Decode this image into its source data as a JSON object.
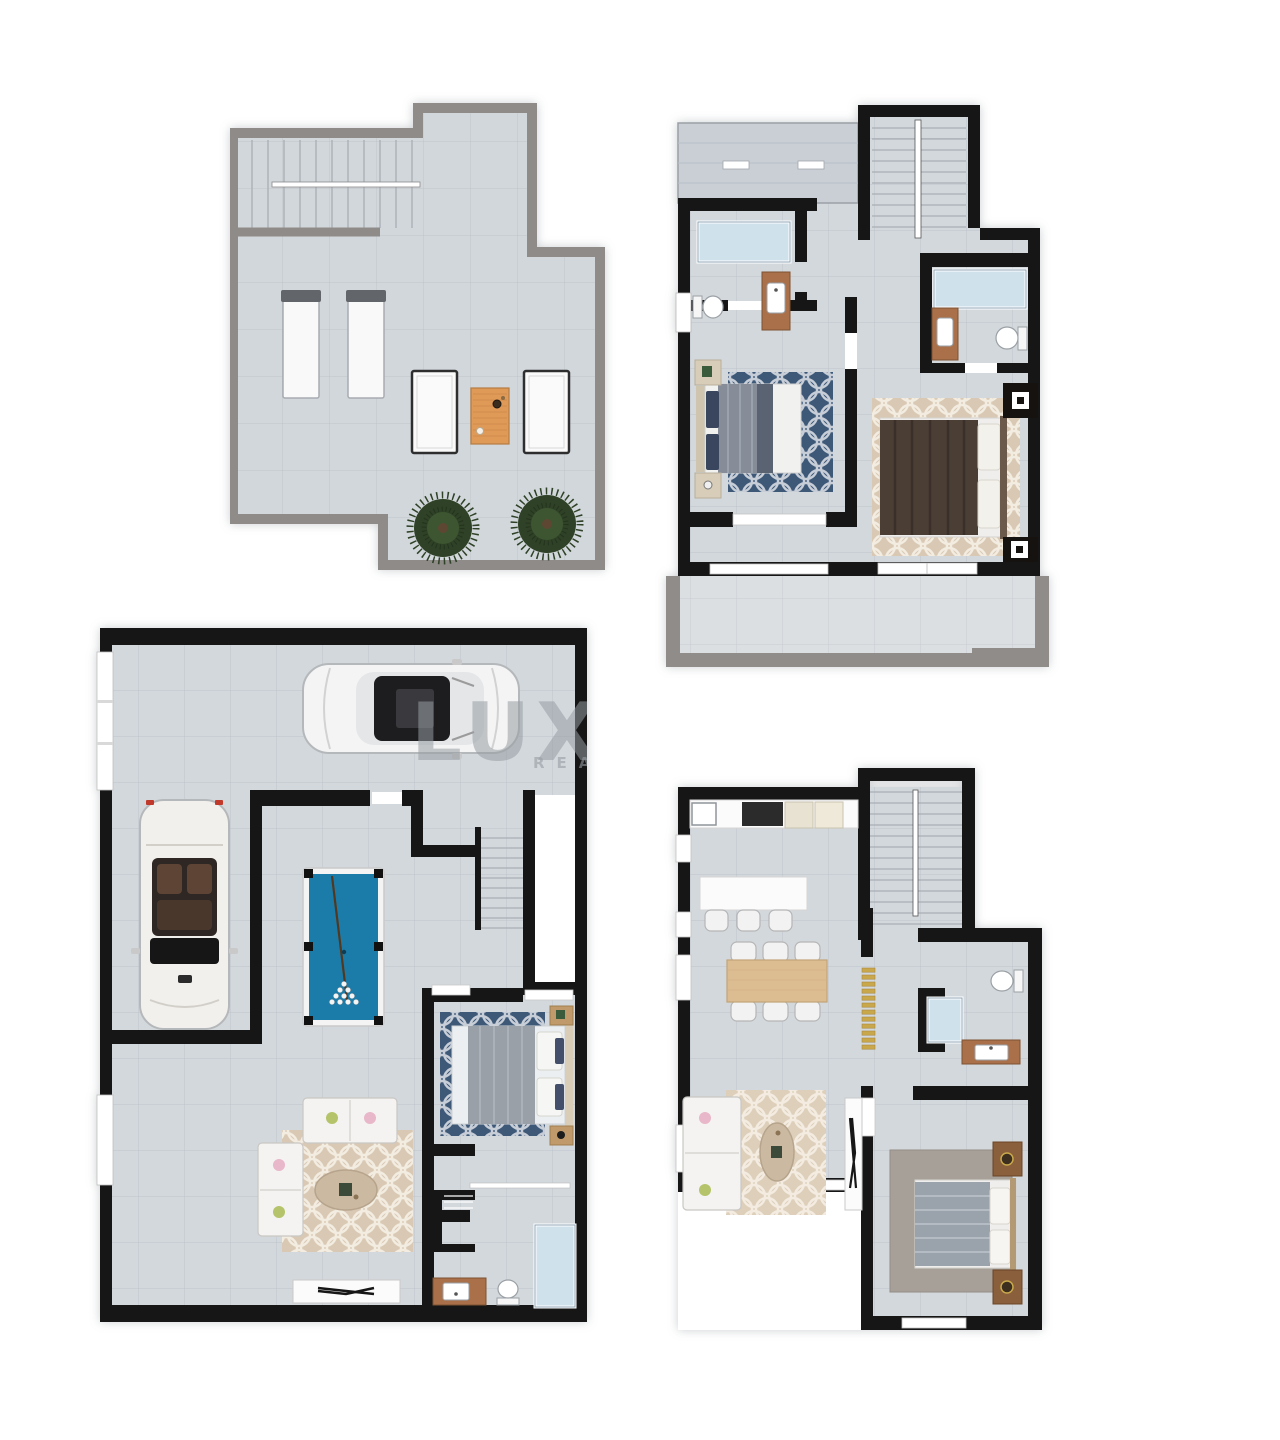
{
  "document": {
    "title": "Villa floor plans - four levels",
    "background": "#ffffff",
    "width": 1280,
    "height": 1440
  },
  "watermark": {
    "line1": "LUX",
    "line2": "REA"
  },
  "palette": {
    "floor_tile": "#d3d8dc",
    "tile_grout": "#bcc3ca",
    "wall_interior": "#161616",
    "wall_parapet": "#908c89",
    "shower_glass": "#cfe2ec",
    "rug_navy": "#3e5878",
    "rug_beige": "#d9c9b4",
    "rug_gray": "#a7a099",
    "billiard_felt": "#1b7ca9",
    "wood_vanity": "#a9704a",
    "wood_dining": "#dcbd92",
    "wood_deck": "#e09a58",
    "slat_gold": "#c9a84c",
    "plant_green": "#2f4227",
    "sofa_white": "#f4f3f1",
    "bed_dark_brown": "#4a3e35",
    "bed_gray": "#9aa0a8"
  },
  "plans": [
    {
      "id": "roof-terrace",
      "position": "top-left",
      "wall_style": "concrete-parapet",
      "rooms": [
        {
          "name": "stair-access",
          "items": [
            "staircase"
          ]
        },
        {
          "name": "terrace",
          "items": [
            "sun-lounger",
            "sun-lounger",
            "lounge-chair",
            "lounge-chair",
            "wood-coffee-table",
            "potted-plant",
            "potted-plant"
          ]
        }
      ]
    },
    {
      "id": "bedroom-floor",
      "position": "top-right",
      "wall_style": "solid-black",
      "rooms": [
        {
          "name": "stairwell",
          "items": [
            "staircase"
          ]
        },
        {
          "name": "bathroom-1",
          "items": [
            "shower",
            "toilet",
            "vanity-sink",
            "window"
          ]
        },
        {
          "name": "bedroom-1",
          "items": [
            "double-bed",
            "night-table",
            "night-table",
            "navy-patterned-rug",
            "window"
          ]
        },
        {
          "name": "bathroom-2",
          "items": [
            "shower",
            "vanity-sink",
            "toilet"
          ]
        },
        {
          "name": "bedroom-2",
          "items": [
            "double-bed",
            "night-table",
            "night-table",
            "beige-patterned-rug"
          ]
        },
        {
          "name": "terrace",
          "items": [
            "parapet",
            "sliding-door"
          ]
        }
      ]
    },
    {
      "id": "basement-garage",
      "position": "bottom-left",
      "wall_style": "solid-black",
      "rooms": [
        {
          "name": "garage",
          "items": [
            "sedan-car",
            "convertible-car",
            "garage-door"
          ]
        },
        {
          "name": "games-area",
          "items": [
            "billiard-table"
          ]
        },
        {
          "name": "stairwell",
          "items": [
            "staircase",
            "lightwell"
          ]
        },
        {
          "name": "lounge",
          "items": [
            "sofa",
            "sofa",
            "beige-patterned-rug",
            "oval-coffee-table",
            "tv-console"
          ]
        },
        {
          "name": "bedroom",
          "items": [
            "double-bed",
            "night-table",
            "night-table",
            "navy-patterned-rug"
          ]
        },
        {
          "name": "bathroom",
          "items": [
            "shower",
            "toilet",
            "vanity-sink",
            "closet"
          ]
        }
      ]
    },
    {
      "id": "ground-floor",
      "position": "bottom-right",
      "wall_style": "solid-black",
      "rooms": [
        {
          "name": "kitchen",
          "items": [
            "sink",
            "cooktop",
            "appliance",
            "appliance",
            "island-counter",
            "bar-stool",
            "bar-stool",
            "bar-stool"
          ]
        },
        {
          "name": "dining",
          "items": [
            "dining-table",
            "dining-chair",
            "dining-chair",
            "dining-chair",
            "dining-chair",
            "dining-chair",
            "dining-chair"
          ]
        },
        {
          "name": "stairwell",
          "items": [
            "staircase"
          ]
        },
        {
          "name": "hall",
          "items": [
            "slatted-screen"
          ]
        },
        {
          "name": "bathroom",
          "items": [
            "shower",
            "toilet",
            "vanity-sink"
          ]
        },
        {
          "name": "living",
          "items": [
            "sofa",
            "beige-patterned-rug",
            "oval-coffee-table",
            "tv-console"
          ]
        },
        {
          "name": "bedroom",
          "items": [
            "double-bed",
            "night-table",
            "night-table",
            "gray-rug",
            "window"
          ]
        }
      ]
    }
  ]
}
